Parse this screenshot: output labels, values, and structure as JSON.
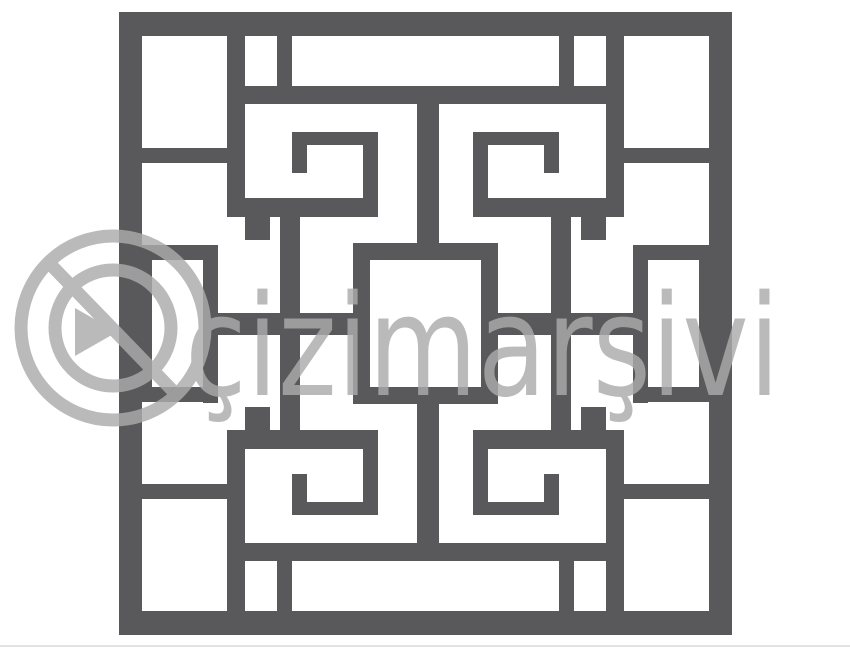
{
  "canvas": {
    "width": 850,
    "height": 648,
    "background": "#ffffff"
  },
  "pattern": {
    "description": "square chinese lattice fretwork stencil with four greek-key spirals and center square",
    "fill": "#59595b",
    "rects": [
      [
        119,
        12,
        613,
        24
      ],
      [
        119,
        611,
        613,
        24
      ],
      [
        119,
        36,
        23,
        575
      ],
      [
        709,
        36,
        23,
        575
      ],
      [
        119,
        148,
        126,
        15
      ],
      [
        606,
        148,
        126,
        15
      ],
      [
        119,
        484,
        126,
        15
      ],
      [
        606,
        484,
        126,
        15
      ],
      [
        119,
        245,
        99,
        15
      ],
      [
        633,
        245,
        99,
        15
      ],
      [
        119,
        387,
        99,
        15
      ],
      [
        633,
        387,
        99,
        15
      ],
      [
        142,
        260,
        10,
        127
      ],
      [
        699,
        260,
        10,
        127
      ],
      [
        203,
        245,
        15,
        158
      ],
      [
        633,
        245,
        15,
        158
      ],
      [
        227,
        36,
        18,
        181
      ],
      [
        606,
        36,
        18,
        181
      ],
      [
        227,
        430,
        18,
        181
      ],
      [
        606,
        430,
        18,
        181
      ],
      [
        277,
        36,
        15,
        50
      ],
      [
        559,
        36,
        15,
        50
      ],
      [
        277,
        561,
        15,
        50
      ],
      [
        559,
        561,
        15,
        50
      ],
      [
        245,
        86,
        361,
        18
      ],
      [
        245,
        543,
        361,
        18
      ],
      [
        417,
        104,
        22,
        139
      ],
      [
        417,
        404,
        22,
        139
      ],
      [
        218,
        313,
        135,
        22
      ],
      [
        498,
        313,
        135,
        22
      ],
      [
        353,
        243,
        145,
        17
      ],
      [
        353,
        387,
        145,
        17
      ],
      [
        353,
        260,
        17,
        127
      ],
      [
        481,
        260,
        17,
        127
      ],
      [
        292,
        132,
        86,
        13
      ],
      [
        292,
        145,
        15,
        28
      ],
      [
        363,
        145,
        15,
        53
      ],
      [
        245,
        198,
        133,
        19
      ],
      [
        473,
        132,
        86,
        13
      ],
      [
        544,
        145,
        15,
        28
      ],
      [
        473,
        145,
        15,
        53
      ],
      [
        473,
        198,
        133,
        19
      ],
      [
        292,
        502,
        86,
        13
      ],
      [
        292,
        474,
        15,
        28
      ],
      [
        363,
        449,
        15,
        53
      ],
      [
        245,
        430,
        133,
        19
      ],
      [
        473,
        502,
        86,
        13
      ],
      [
        544,
        474,
        15,
        28
      ],
      [
        473,
        449,
        15,
        53
      ],
      [
        473,
        430,
        133,
        19
      ],
      [
        245,
        217,
        25,
        23
      ],
      [
        581,
        217,
        25,
        23
      ],
      [
        245,
        407,
        25,
        23
      ],
      [
        581,
        407,
        25,
        23
      ],
      [
        280,
        217,
        20,
        96
      ],
      [
        551,
        217,
        20,
        96
      ],
      [
        280,
        334,
        20,
        96
      ],
      [
        551,
        334,
        20,
        96
      ]
    ]
  },
  "watermark": {
    "text": "çizimarşivi",
    "color": "#ababab",
    "opacity": 0.82,
    "font_size": 140,
    "text_x": 185,
    "text_baseline_y": 395,
    "text_length": 595,
    "logo": {
      "cx": 113,
      "cy": 328,
      "inner_radius": 58,
      "outer_radius": 92,
      "stroke_width": 13,
      "slash": {
        "x1": 52,
        "y1": 266,
        "x2": 172,
        "y2": 390
      },
      "triangle_points": "75,308 75,356 117,332"
    }
  },
  "edge_line": {
    "color": "#e2e2e2",
    "y": 645
  }
}
